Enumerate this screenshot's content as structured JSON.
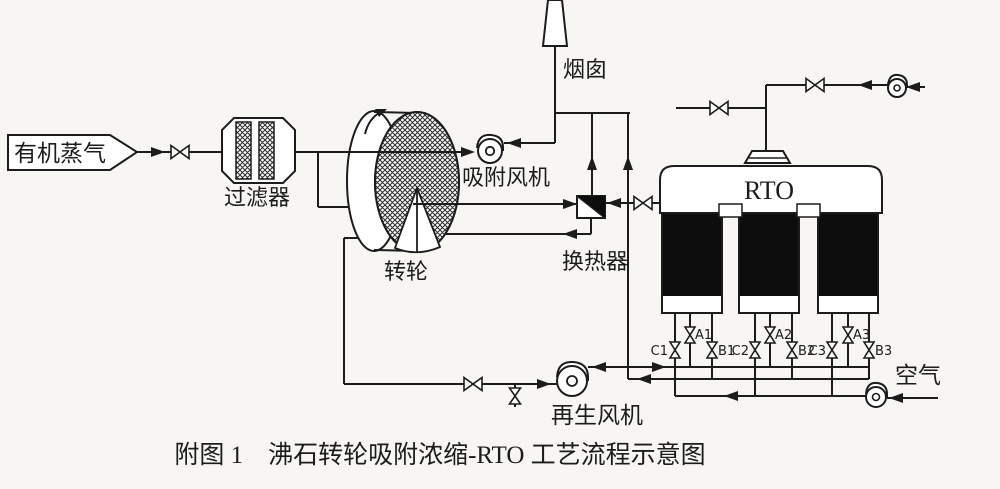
{
  "figure": {
    "caption": "附图 1　沸石转轮吸附浓缩-RTO 工艺流程示意图",
    "labels": {
      "organic_vapor": "有机蒸气",
      "filter": "过滤器",
      "rotor": "转轮",
      "adsorption_fan": "吸附风机",
      "stack": "烟囱",
      "heat_exchanger": "换热器",
      "regen_fan": "再生风机",
      "rto": "RTO",
      "air": "空气"
    },
    "valves": {
      "a1": "A1",
      "b1": "B1",
      "c1": "C1",
      "a2": "A2",
      "b2": "B2",
      "c2": "C2",
      "a3": "A3",
      "b3": "B3",
      "c3": "C3"
    },
    "colors": {
      "line": "#1c1c1c",
      "bed_fill": "#0d0d0d",
      "paper": "#f7f6f2"
    }
  }
}
